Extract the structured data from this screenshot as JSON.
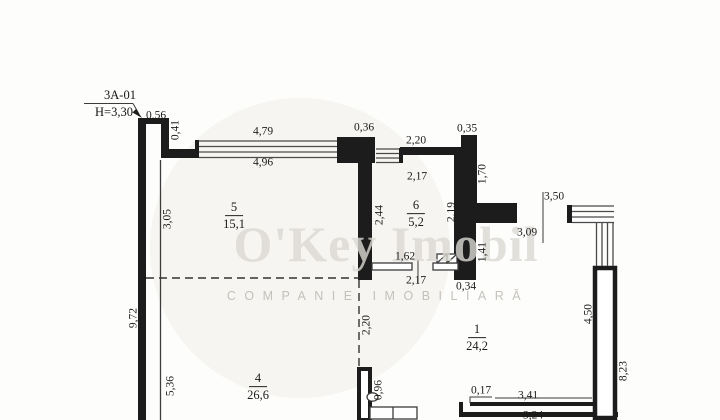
{
  "title_block": {
    "unit": "3А-01",
    "height": "Н=3,30"
  },
  "watermark": {
    "brand": "O'Key Imobil",
    "subtitle": "COMPANIE IMOBILIARĂ"
  },
  "rooms": [
    {
      "number": "5",
      "area": "15,1"
    },
    {
      "number": "6",
      "area": "5,2"
    },
    {
      "number": "4",
      "area": "26,6"
    },
    {
      "number": "1",
      "area": "24,2"
    }
  ],
  "dims": [
    {
      "id": "top-step-width",
      "value": "0,56"
    },
    {
      "id": "top-step-height",
      "value": "0,41"
    },
    {
      "id": "window-top-outer",
      "value": "4,79"
    },
    {
      "id": "window-top-inner",
      "value": "4,96"
    },
    {
      "id": "pier-width",
      "value": "0,36"
    },
    {
      "id": "room6-top-wall",
      "value": "2,20"
    },
    {
      "id": "right-pier-width",
      "value": "0,35"
    },
    {
      "id": "room6-width-top",
      "value": "2,17"
    },
    {
      "id": "right-wall-upper",
      "value": "1,70"
    },
    {
      "id": "room6-height-left",
      "value": "2,44"
    },
    {
      "id": "room6-height-right",
      "value": "2,19"
    },
    {
      "id": "opening-outer",
      "value": "3,50"
    },
    {
      "id": "opening-inner",
      "value": "3,09"
    },
    {
      "id": "room6-door",
      "value": "1,62"
    },
    {
      "id": "stub-length",
      "value": "1,41"
    },
    {
      "id": "room6-width-bottom",
      "value": "2,17"
    },
    {
      "id": "stub-width",
      "value": "0,34"
    },
    {
      "id": "room5-height",
      "value": "3,05"
    },
    {
      "id": "left-wall-total",
      "value": "9,72"
    },
    {
      "id": "room4-height",
      "value": "5,36"
    },
    {
      "id": "virtual-split",
      "value": "2,20"
    },
    {
      "id": "middle-stub",
      "value": "0,96"
    },
    {
      "id": "room1-height-inner",
      "value": "4,50"
    },
    {
      "id": "right-wall-total",
      "value": "8,23"
    },
    {
      "id": "bottom-step",
      "value": "0,17"
    },
    {
      "id": "bottom-wall-outer",
      "value": "3,41"
    },
    {
      "id": "bottom-wall-inner",
      "value": "3,24"
    }
  ],
  "colors": {
    "wall": "#1c1c1c",
    "paper": "#fdfdfc",
    "watermark": "#dcd9d3"
  }
}
